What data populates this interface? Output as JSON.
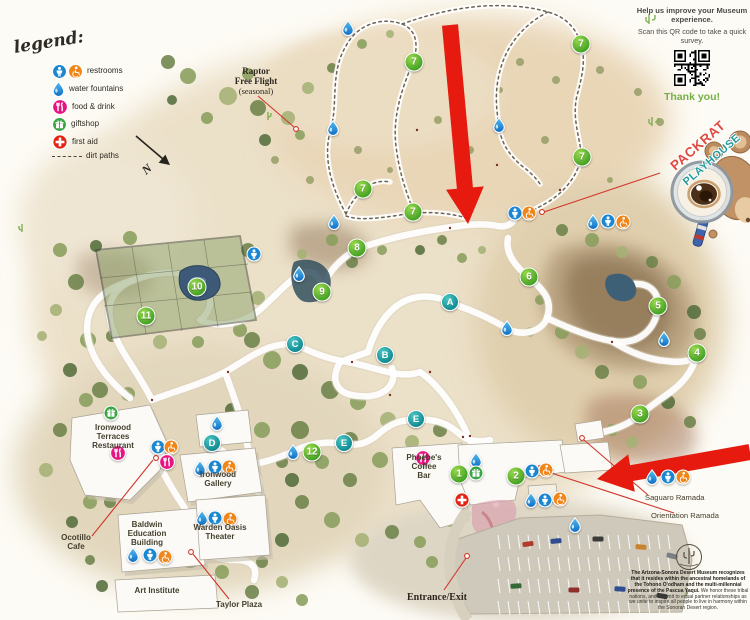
{
  "legend": {
    "title": "legend:",
    "items": [
      {
        "type": "restrooms",
        "label": "restrooms"
      },
      {
        "type": "water",
        "label": "water fountains"
      },
      {
        "type": "food",
        "label": "food & drink"
      },
      {
        "type": "gift",
        "label": "giftshop"
      },
      {
        "type": "firstaid",
        "label": "first aid"
      },
      {
        "type": "dirt",
        "label": "dirt paths"
      }
    ]
  },
  "compass": {
    "label": "N"
  },
  "survey": {
    "heading": "Help us improve your Museum experience.",
    "body": "Scan this QR code to take a quick survey.",
    "thanks": "Thank you!"
  },
  "playhouse": {
    "line1": "PACKRAT",
    "line2": "PLAYHOUSE"
  },
  "acknowledgment": {
    "bold": "The Arizona-Sonora Desert Museum recognizes that it resides within the ancestral homelands of the Tohono O'odham and the multi-millennial presence of the Pascua Yaqui.",
    "regular": " We honor these tribal nations, and commit to equal partner relationships as we unite to inspire all people to live in harmony within the Sonoran Desert region."
  },
  "map": {
    "labels": [
      {
        "id": "raptor",
        "text": "Raptor\nFree Flight",
        "x": 256,
        "y": 66,
        "size": 9,
        "weight": 700,
        "font": "serif"
      },
      {
        "id": "raptor-seasonal",
        "text": "(seasonal)",
        "x": 256,
        "y": 87,
        "size": 8.5,
        "weight": 400,
        "font": "serif"
      },
      {
        "id": "ironwood-terraces",
        "text": "Ironwood\nTerraces\nRestaurant",
        "x": 113,
        "y": 424,
        "size": 8,
        "weight": 600
      },
      {
        "id": "ironwood-gallery",
        "text": "Ironwood\nGallery",
        "x": 218,
        "y": 471,
        "size": 8,
        "weight": 600
      },
      {
        "id": "ocotillo-cafe",
        "text": "Ocotillo\nCafe",
        "x": 76,
        "y": 534,
        "size": 8,
        "weight": 600
      },
      {
        "id": "baldwin-education",
        "text": "Baldwin\nEducation\nBuilding",
        "x": 147,
        "y": 521,
        "size": 8,
        "weight": 600
      },
      {
        "id": "warden-oasis",
        "text": "Warden Oasis\nTheater",
        "x": 220,
        "y": 524,
        "size": 8,
        "weight": 600
      },
      {
        "id": "art-institute",
        "text": "Art Institute",
        "x": 157,
        "y": 587,
        "size": 8,
        "weight": 600
      },
      {
        "id": "taylor-plaza",
        "text": "Taylor Plaza",
        "x": 239,
        "y": 601,
        "size": 8,
        "weight": 600
      },
      {
        "id": "phoebes-coffee-bar",
        "text": "Phoebe's\nCoffee\nBar",
        "x": 424,
        "y": 454,
        "size": 8,
        "weight": 600
      },
      {
        "id": "entrance-exit",
        "text": "Entrance/Exit",
        "x": 437,
        "y": 592,
        "size": 10,
        "weight": 700,
        "font": "serif"
      },
      {
        "id": "saguaro-ramada",
        "text": "Saguaro Ramada",
        "x": 645,
        "y": 494,
        "size": 7.6,
        "weight": 500,
        "align": "left"
      },
      {
        "id": "orientation-ramada",
        "text": "Orientation Ramada",
        "x": 651,
        "y": 512,
        "size": 7.6,
        "weight": 500,
        "align": "left"
      }
    ],
    "markers": [
      {
        "t": "num",
        "l": "1",
        "x": 459,
        "y": 474
      },
      {
        "t": "num",
        "l": "2",
        "x": 516,
        "y": 476
      },
      {
        "t": "num",
        "l": "3",
        "x": 640,
        "y": 414
      },
      {
        "t": "num",
        "l": "4",
        "x": 697,
        "y": 353
      },
      {
        "t": "num",
        "l": "5",
        "x": 658,
        "y": 306
      },
      {
        "t": "num",
        "l": "6",
        "x": 529,
        "y": 277
      },
      {
        "t": "num",
        "l": "7",
        "x": 414,
        "y": 62
      },
      {
        "t": "num",
        "l": "7",
        "x": 581,
        "y": 44
      },
      {
        "t": "num",
        "l": "7",
        "x": 582,
        "y": 157
      },
      {
        "t": "num",
        "l": "7",
        "x": 363,
        "y": 189
      },
      {
        "t": "num",
        "l": "7",
        "x": 413,
        "y": 212
      },
      {
        "t": "num",
        "l": "8",
        "x": 357,
        "y": 248
      },
      {
        "t": "num",
        "l": "9",
        "x": 322,
        "y": 292
      },
      {
        "t": "num",
        "l": "10",
        "x": 197,
        "y": 287
      },
      {
        "t": "num",
        "l": "11",
        "x": 146,
        "y": 316
      },
      {
        "t": "num",
        "l": "12",
        "x": 312,
        "y": 452
      },
      {
        "t": "let",
        "l": "A",
        "x": 450,
        "y": 302
      },
      {
        "t": "let",
        "l": "B",
        "x": 385,
        "y": 355
      },
      {
        "t": "let",
        "l": "C",
        "x": 295,
        "y": 344
      },
      {
        "t": "let",
        "l": "D",
        "x": 212,
        "y": 443
      },
      {
        "t": "let",
        "l": "E",
        "x": 344,
        "y": 443
      },
      {
        "t": "let",
        "l": "E",
        "x": 416,
        "y": 419
      },
      {
        "t": "water",
        "x": 348,
        "y": 28
      },
      {
        "t": "water",
        "x": 333,
        "y": 128
      },
      {
        "t": "water",
        "x": 334,
        "y": 222
      },
      {
        "t": "water",
        "x": 499,
        "y": 125
      },
      {
        "t": "water",
        "x": 299,
        "y": 274
      },
      {
        "t": "water",
        "x": 507,
        "y": 328
      },
      {
        "t": "water",
        "x": 664,
        "y": 339
      },
      {
        "t": "water",
        "x": 593,
        "y": 222
      },
      {
        "t": "water",
        "x": 652,
        "y": 477
      },
      {
        "t": "water",
        "x": 217,
        "y": 423
      },
      {
        "t": "water",
        "x": 200,
        "y": 468
      },
      {
        "t": "water",
        "x": 202,
        "y": 518
      },
      {
        "t": "water",
        "x": 133,
        "y": 555
      },
      {
        "t": "water",
        "x": 476,
        "y": 460
      },
      {
        "t": "water",
        "x": 531,
        "y": 500
      },
      {
        "t": "water",
        "x": 575,
        "y": 525
      },
      {
        "t": "water",
        "x": 293,
        "y": 452
      },
      {
        "t": "rest",
        "x": 254,
        "y": 254
      },
      {
        "t": "rest",
        "x": 515,
        "y": 213
      },
      {
        "t": "rest",
        "x": 608,
        "y": 221
      },
      {
        "t": "rest",
        "x": 158,
        "y": 447
      },
      {
        "t": "rest",
        "x": 215,
        "y": 467
      },
      {
        "t": "rest",
        "x": 215,
        "y": 518
      },
      {
        "t": "rest",
        "x": 150,
        "y": 555
      },
      {
        "t": "rest",
        "x": 532,
        "y": 471
      },
      {
        "t": "rest",
        "x": 545,
        "y": 500
      },
      {
        "t": "rest",
        "x": 668,
        "y": 477
      },
      {
        "t": "acc",
        "x": 529,
        "y": 213
      },
      {
        "t": "acc",
        "x": 623,
        "y": 222
      },
      {
        "t": "acc",
        "x": 171,
        "y": 447
      },
      {
        "t": "acc",
        "x": 229,
        "y": 467
      },
      {
        "t": "acc",
        "x": 230,
        "y": 519
      },
      {
        "t": "acc",
        "x": 165,
        "y": 557
      },
      {
        "t": "acc",
        "x": 546,
        "y": 470
      },
      {
        "t": "acc",
        "x": 560,
        "y": 499
      },
      {
        "t": "acc",
        "x": 683,
        "y": 477
      },
      {
        "t": "gift",
        "x": 111,
        "y": 413
      },
      {
        "t": "gift",
        "x": 476,
        "y": 473
      },
      {
        "t": "food",
        "x": 118,
        "y": 453
      },
      {
        "t": "food",
        "x": 167,
        "y": 462
      },
      {
        "t": "food",
        "x": 423,
        "y": 458
      },
      {
        "t": "aid",
        "x": 462,
        "y": 500
      }
    ]
  }
}
